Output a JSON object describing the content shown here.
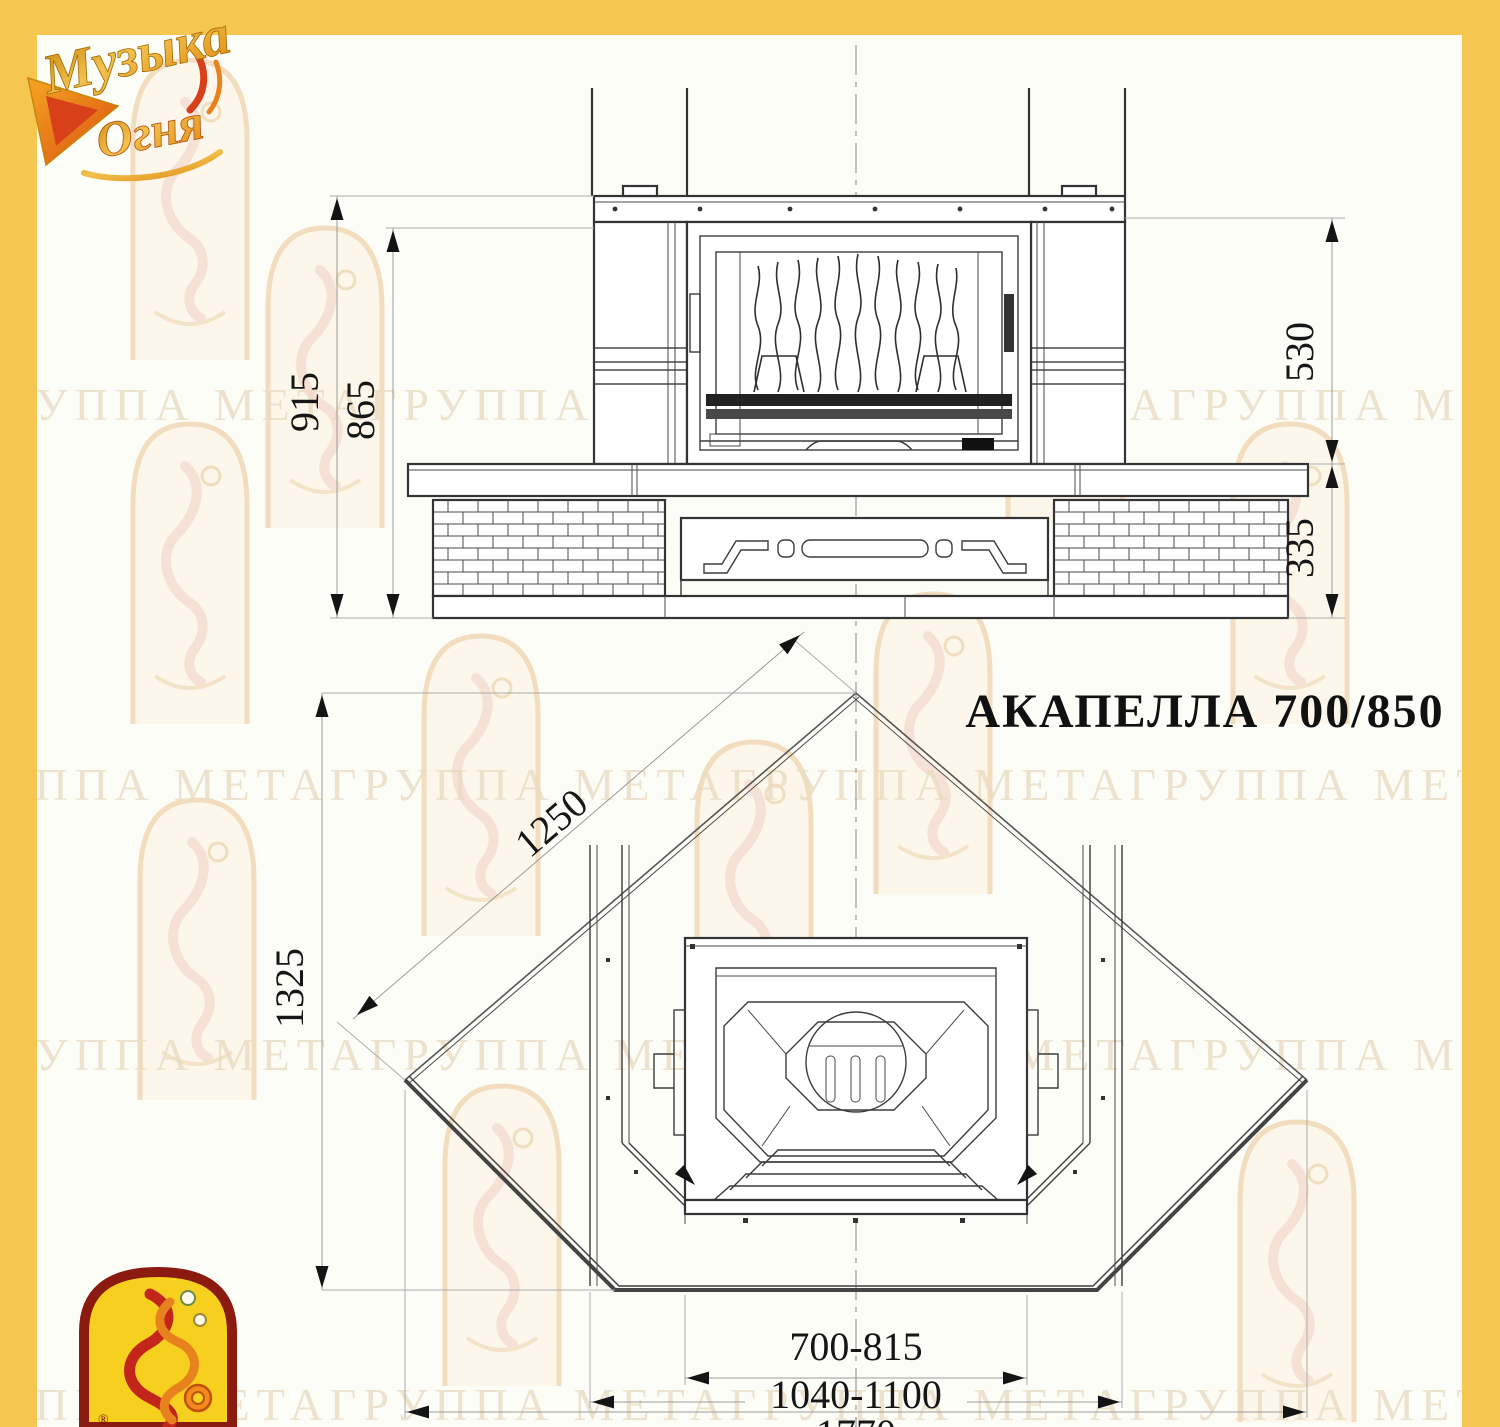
{
  "brand": {
    "logo_word1": "Музыка",
    "logo_word2": "Огня",
    "registered_mark": "®"
  },
  "watermark": {
    "row_text": "ГРУППА МЕТАГРУППА МЕТАГРУППА МЕТАГРУППА МЕТА"
  },
  "title": {
    "model_name": "АКАПЕЛЛА 700/850"
  },
  "front_view": {
    "dim_total_height": "915",
    "dim_body_height": "865",
    "dim_upper_height": "530",
    "dim_base_height": "335"
  },
  "plan_view": {
    "dim_side_length": "1250",
    "dim_depth": "1325",
    "dim_firebox_width": "700-815",
    "dim_portal_width": "1040-1100",
    "dim_total_width": "1770"
  },
  "colors": {
    "frame_yellow": "#F6C750",
    "line_dark": "#3c3c3c",
    "dim_text": "#161616",
    "watermark_tone": "#eadcc3",
    "logo_gold": "#E9A11B",
    "logo_red": "#D8401A"
  }
}
